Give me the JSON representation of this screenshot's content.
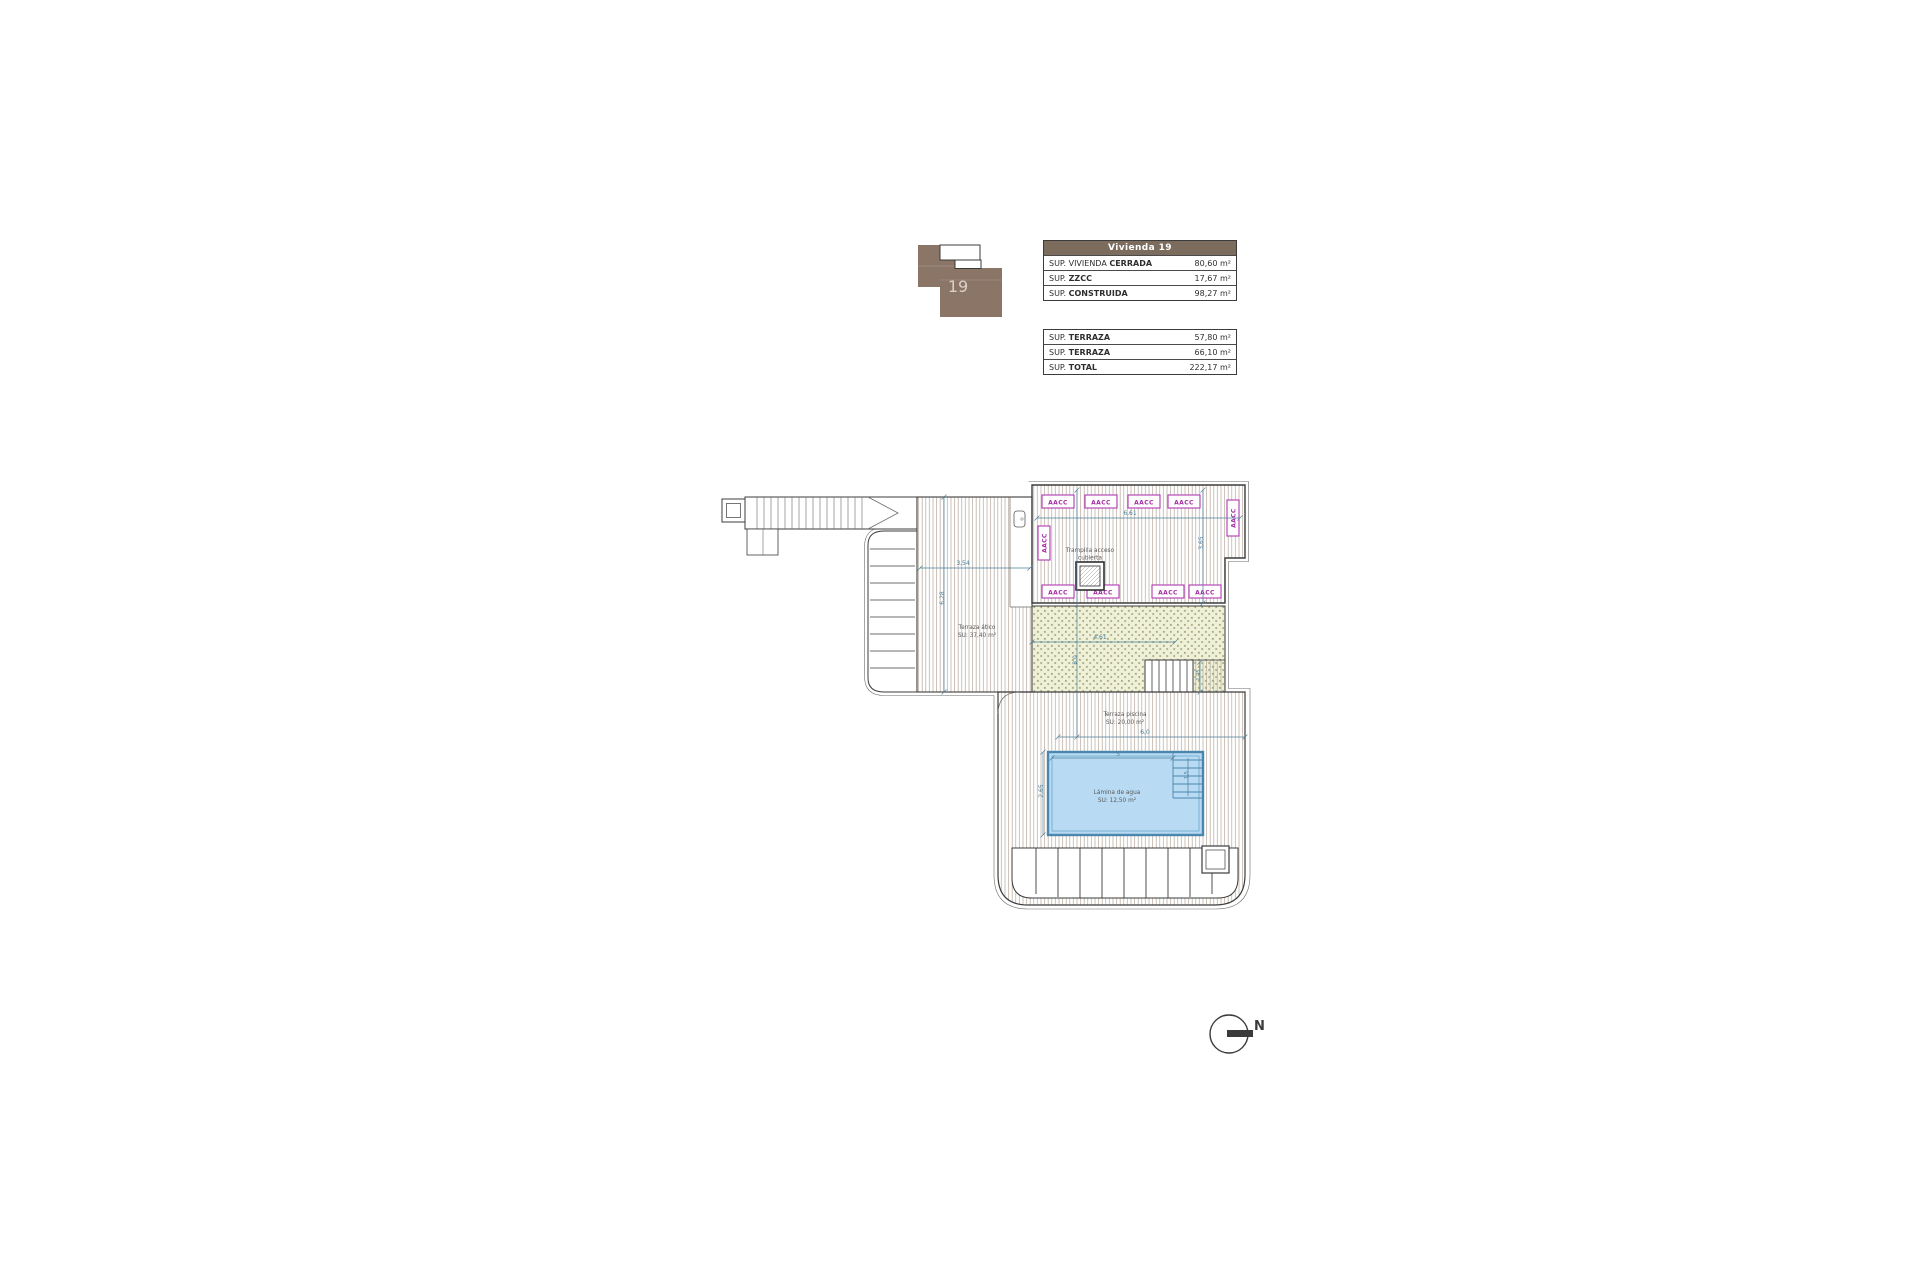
{
  "key_plan": {
    "unit": "19"
  },
  "tables": {
    "main": {
      "header": "Vivienda 19",
      "rows": [
        {
          "prefix": "SUP. VIVIENDA ",
          "bold": "CERRADA",
          "value": "80,60 m²"
        },
        {
          "prefix": "SUP. ",
          "bold": "ZZCC",
          "value": "17,67 m²"
        },
        {
          "prefix": "SUP. ",
          "bold": "CONSTRUIDA",
          "value": "98,27 m²"
        }
      ]
    },
    "secondary": {
      "rows": [
        {
          "prefix": "SUP. ",
          "bold": "TERRAZA",
          "value": "57,80 m²"
        },
        {
          "prefix": "SUP. ",
          "bold": "TERRAZA",
          "value": "66,10 m²"
        },
        {
          "prefix": "SUP. ",
          "bold": "TOTAL",
          "value": "222,17 m²"
        }
      ]
    }
  },
  "plan": {
    "areas": {
      "terraza_atico": {
        "line1": "Terraza ático",
        "line2": "SU: 37,40 m²"
      },
      "terraza_piscina": {
        "line1": "Terraza piscina",
        "line2": "SU: 20,00 m²"
      },
      "lamina_agua": {
        "line1": "Lámina de agua",
        "line2": "SU: 12,50 m²"
      },
      "trampilla": {
        "line1": "Trampilla acceso",
        "line2": "cubierta"
      }
    },
    "equipment_label": "AACC",
    "dims": {
      "terrace_w": "3,54",
      "terrace_h": "6,28",
      "roof_w": "6,61",
      "roof_h": "3,65",
      "pergola_w": "4,61",
      "total_h": "8,0",
      "stairs_h": "1,05",
      "lower_w": "6,0",
      "pool_w": "5",
      "pool_h": "2,65",
      "steps_h": "1,5"
    },
    "north": "N"
  },
  "colors": {
    "key_plan_brown": "#8b7566",
    "table_header_bg": "#7c6c5e",
    "hatch_line": "#b5a79a",
    "stipple_bg": "#eef0d8",
    "stipple_mark": "#8f8f5e",
    "aacc_magenta": "#b03ab0",
    "dimension_teal": "#4d7f99",
    "pool_fill": "#b8daf2",
    "pool_edge": "#4a86ad",
    "wall": "#3c3c3c"
  }
}
